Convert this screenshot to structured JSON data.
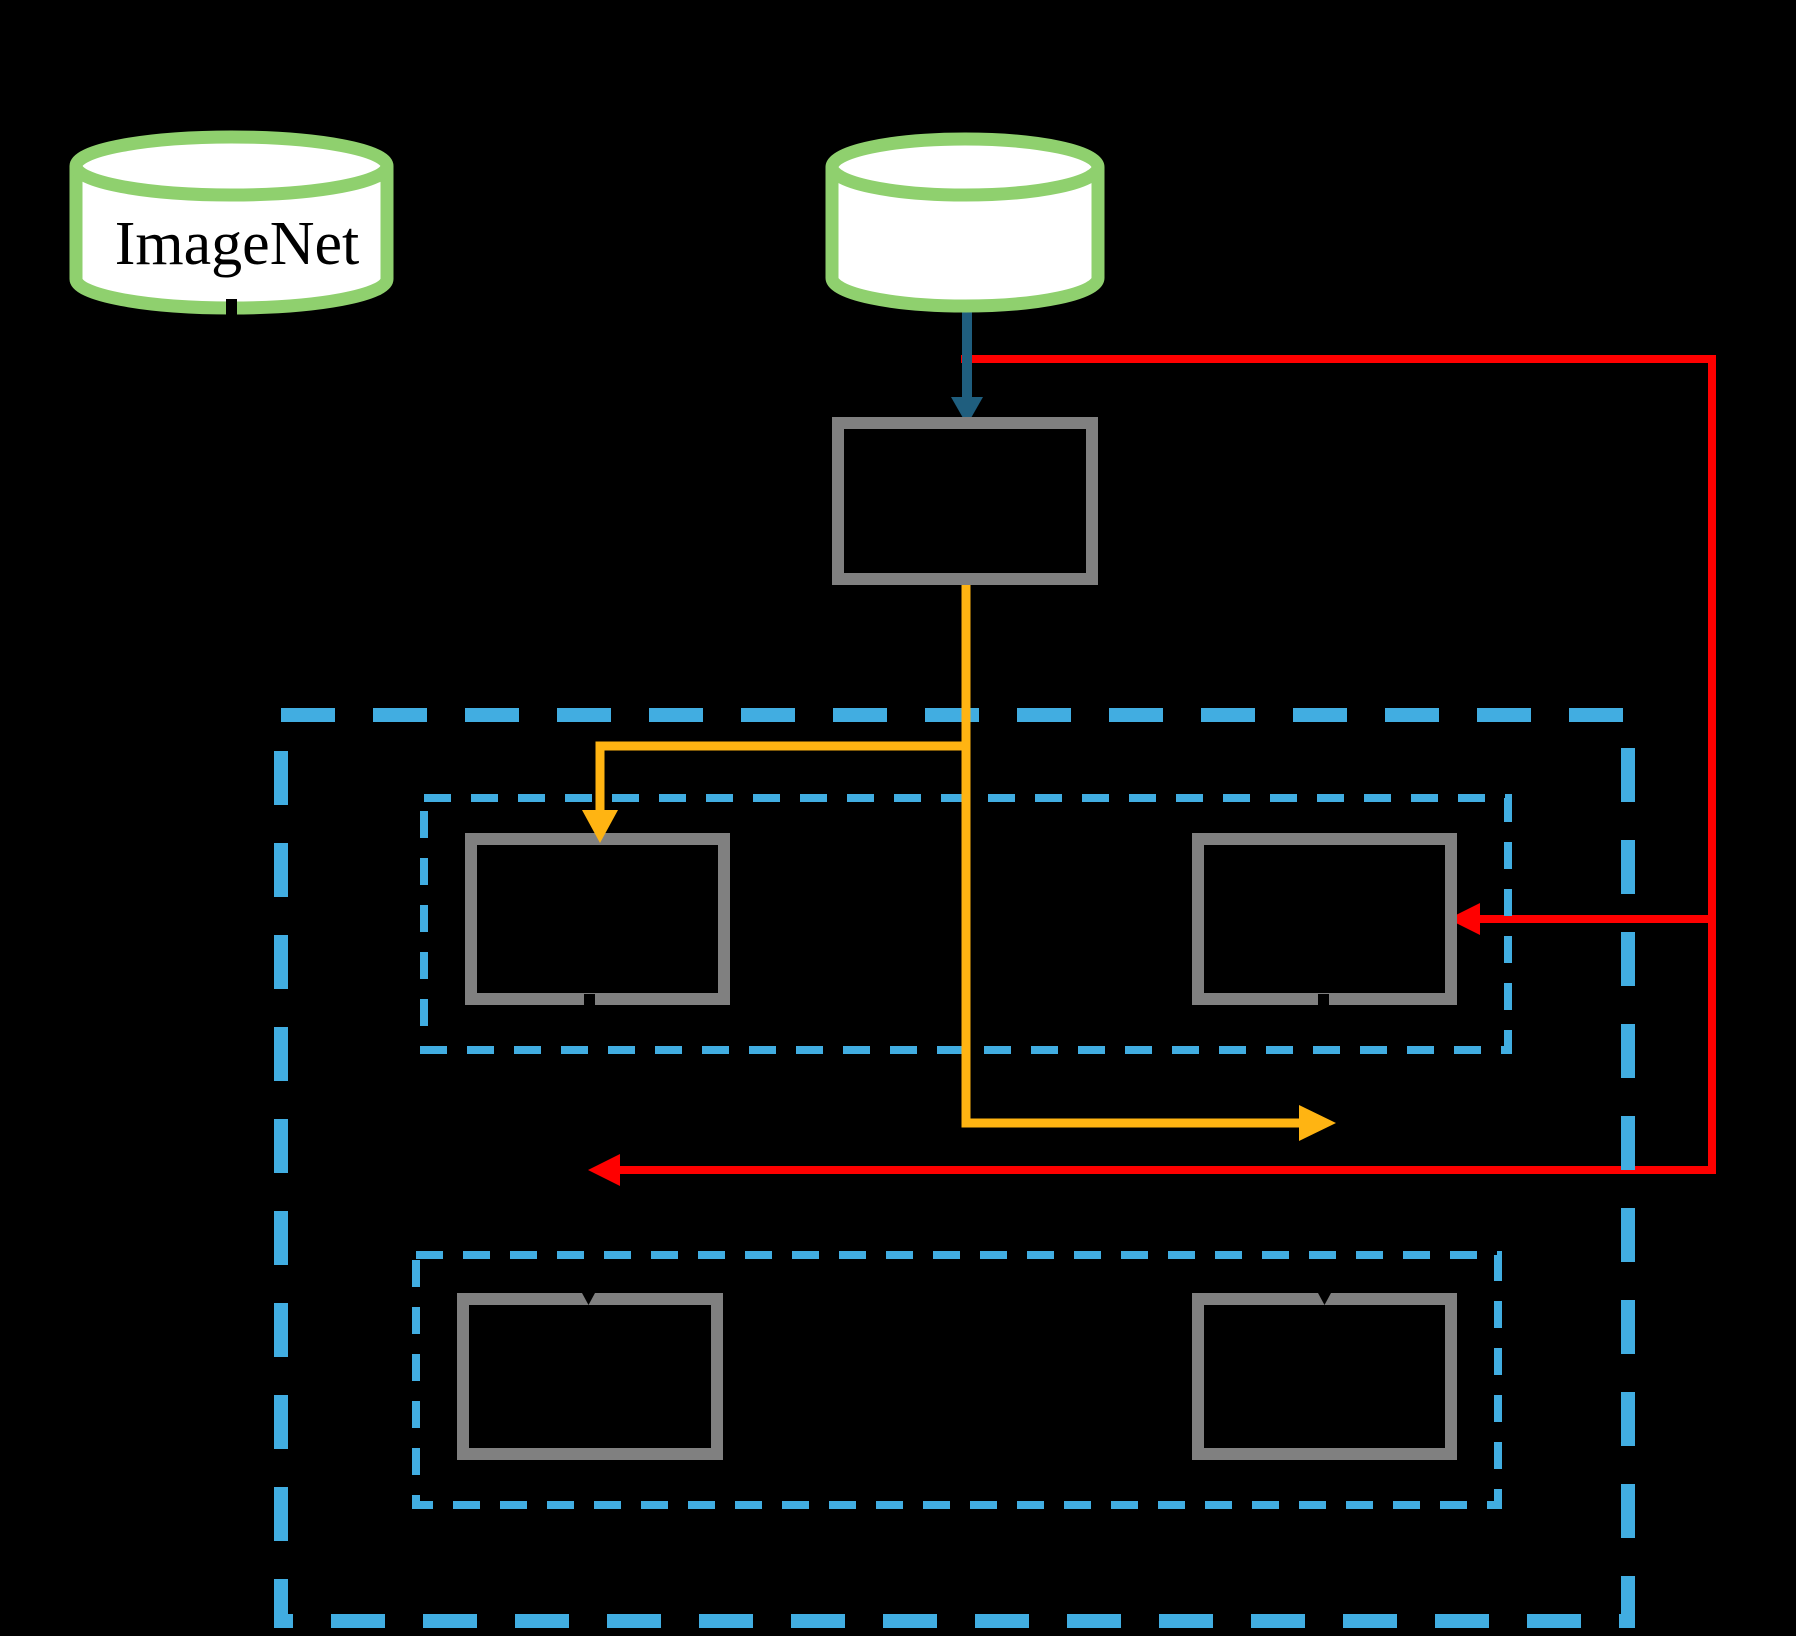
{
  "page": {
    "background": "#000000"
  },
  "colors": {
    "database_border_green": "#8fd06e",
    "database_fill_white": "#ffffff",
    "process_box_gray": "#808080",
    "dashed_container_blue": "#41ade1",
    "arrow_teal": "#1f5e7e",
    "arrow_yellow": "#ffb412",
    "arrow_red": "#ff0000",
    "connector_black": "#000000",
    "label_black": "#000000"
  },
  "nodes": {
    "imagenet_database": {
      "label": "ImageNet",
      "icon": "database-cylinder-icon"
    },
    "second_database": {
      "label": "",
      "icon": "database-cylinder-icon"
    }
  }
}
